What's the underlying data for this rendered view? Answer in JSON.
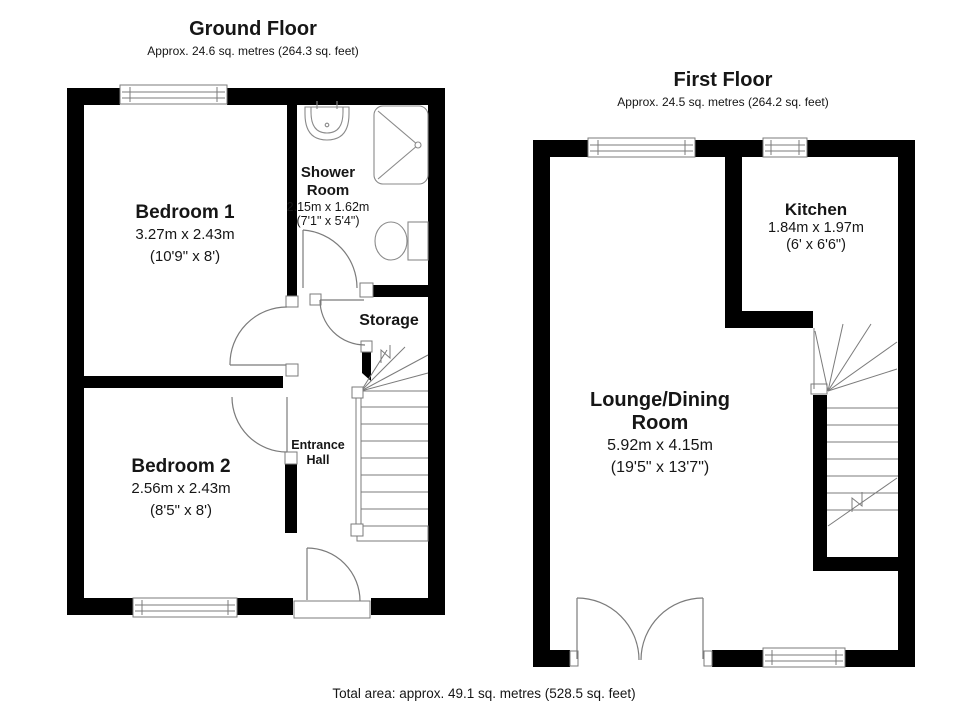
{
  "page": {
    "total_area": "Total area: approx. 49.1 sq. metres (528.5 sq. feet)"
  },
  "colors": {
    "wall": "#000000",
    "line": "#7b7b7b",
    "background": "#ffffff",
    "text": "#161616"
  },
  "floors": {
    "ground": {
      "title": "Ground Floor",
      "subtitle": "Approx. 24.6 sq. metres (264.3 sq. feet)"
    },
    "first": {
      "title": "First Floor",
      "subtitle": "Approx. 24.5 sq. metres (264.2 sq. feet)"
    }
  },
  "rooms": {
    "bedroom1": {
      "name": "Bedroom 1",
      "metric": "3.27m x 2.43m",
      "imperial": "(10'9\" x 8')"
    },
    "bedroom2": {
      "name": "Bedroom 2",
      "metric": "2.56m x 2.43m",
      "imperial": "(8'5\" x 8')"
    },
    "shower": {
      "name": "Shower Room",
      "metric": "2.15m x 1.62m",
      "imperial": "(7'1\" x 5'4\")"
    },
    "storage": {
      "name": "Storage"
    },
    "hall": {
      "name": "Entrance Hall"
    },
    "kitchen": {
      "name": "Kitchen",
      "metric": "1.84m x 1.97m",
      "imperial": "(6' x 6'6\")"
    },
    "lounge": {
      "name": "Lounge/Dining Room",
      "metric": "5.92m x 4.15m",
      "imperial": "(19'5\" x 13'7\")"
    }
  },
  "icons": {
    "sink": "sink-icon",
    "shower_tray": "shower-tray-icon",
    "toilet": "toilet-icon",
    "stairs": "staircase-icon",
    "window": "window-icon",
    "door": "door-swing-icon"
  }
}
